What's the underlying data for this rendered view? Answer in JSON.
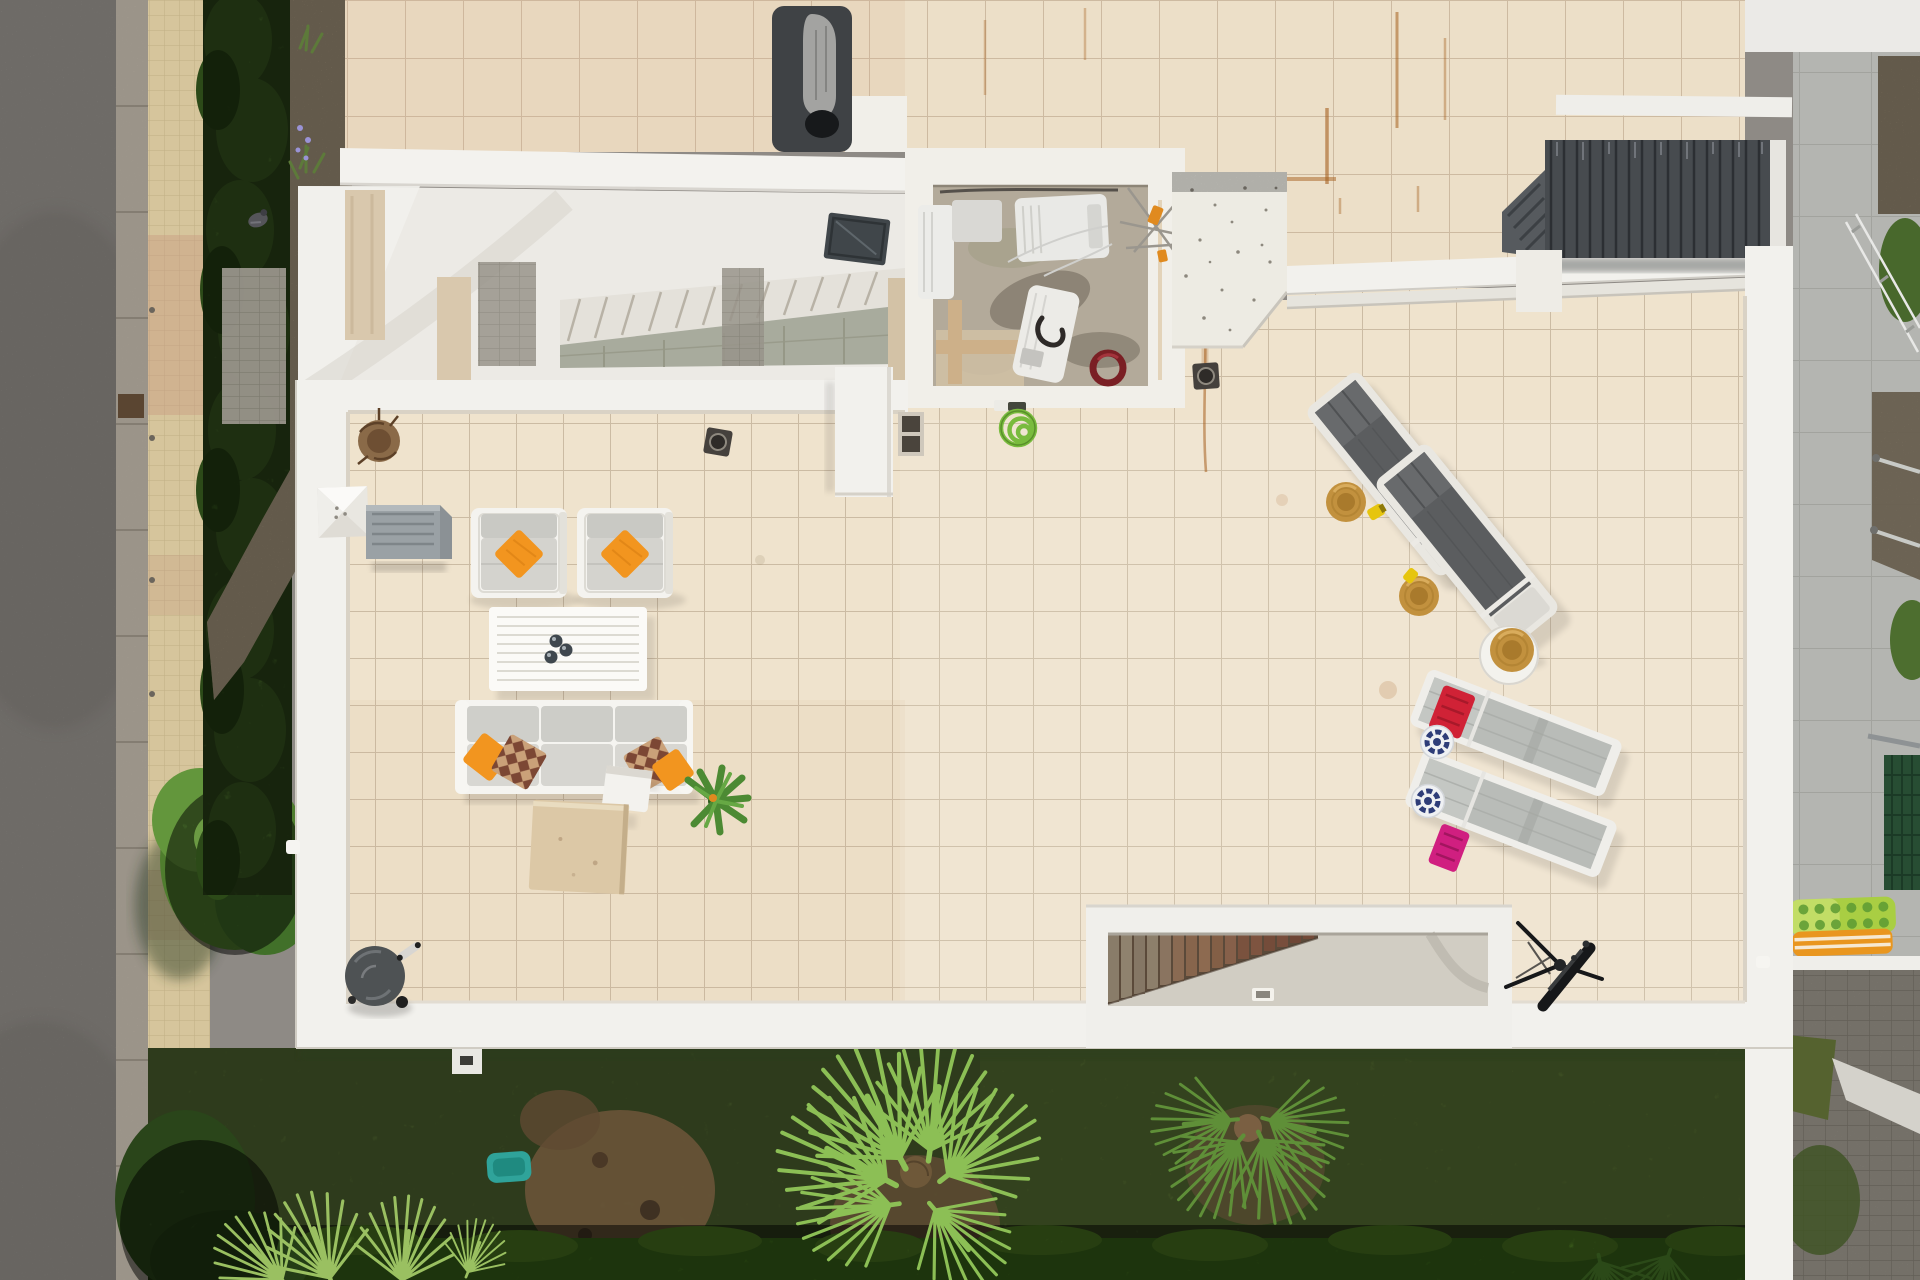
{
  "scene": {
    "description": "Top-down aerial drone photo of a white villa rooftop terrace with outdoor lounge furniture, sun loungers with straw hats, a machine room, a dark pergola, a wooden staircase opening, a telescope, a barbecue, bordered by a road, hedges and a garden with fan palms",
    "view": "top-down aerial"
  },
  "palette": {
    "road": "#8e8a85",
    "curb": "#b2aa9d",
    "sidewalk": "#d6c59c",
    "hedge_dark": "#34511e",
    "gravel": "#9a8c74",
    "wall_white": "#f2f1ed",
    "tile_main": "#efe3cd",
    "tile_upper": "#ecdfc8",
    "grout": "#cbbba3",
    "rust": "#a55f1e",
    "porch_ceiling": "#eceae5",
    "machine_floor": "#b3aa9a",
    "pergola_dark": "#474b4f",
    "lounger_dark_fabric": "#5b5d5f",
    "lounger_light_fabric": "#b9bcb8",
    "cushion_gray": "#d4d3ce",
    "pillow_orange": "#f2951f",
    "hat_straw": "#c2913e",
    "towel_red": "#d02236",
    "towel_pink": "#d01f80",
    "hat_navy": "#2e3d78",
    "stair_wood": "#86654d",
    "landing_concrete": "#d1cdc3",
    "grass": "#4c612e",
    "hedge_bright": "#3c6a1b",
    "palm_green": "#8cbf55",
    "neighbor_tile": "#b4b5b1",
    "cobble": "#8f8a80",
    "float_lime": "#a9ce43",
    "float_orange": "#e9961f",
    "teal_roller": "#2fa39a",
    "bbq_lid": "#4e5254",
    "telescope_black": "#17181a"
  },
  "objects": {
    "road": "asphalt road",
    "sidewalk": "tan tiled sidewalk",
    "hedge_row": "tall hedge row along sidewalk",
    "gravel_bed": "gravel planting bed with small plants",
    "big_tree": "leafy green tree over the sidewalk",
    "upper_roof": "upper tiled roof terrace",
    "sculpture": "gray sculpture on dark mat",
    "porch": "double-height porch void with interior staircase",
    "interior_stairs": "interior staircase seen through void",
    "skylight": "dark roof skylight",
    "machine_room": "open machine room with AC units, cables and antenna",
    "hose_coil_red": "coiled red hose",
    "concrete_block": "white concrete block structure",
    "pergola": "dark slatted pergola",
    "upper_parapet": "white parapet wall between terraces",
    "main_terrace": "large cream tiled rooftop terrace",
    "pyramid_cap": "white pyramid skylight cap",
    "gray_box": "gray metal unit",
    "dried_plant": "dried round plant",
    "armchair_left": "outdoor armchair with orange pillow",
    "armchair_right": "outdoor armchair with orange pillow",
    "coffee_table": "white slatted coffee table with cups",
    "sofa": "three-seat outdoor sofa with orange and patterned pillows",
    "planter_white": "white cube planter",
    "green_plant": "green potted plant",
    "sand_cube": "sand colored concrete cube",
    "hose_spiral": "green spiral hose on tap",
    "drain": "square floor drain",
    "wall_pillar": "white chimney pillar",
    "lounger_dark_1": "sun lounger with dark fabric and straw hat",
    "lounger_dark_2": "sun lounger with dark fabric and straw hat",
    "round_table": "round white table with straw hat",
    "lounger_light_1": "light gray sun lounger with red towel and patterned hat",
    "lounger_light_2": "light gray sun lounger with pink towel and patterned hat",
    "stairwell": "staircase opening with wooden treads and concrete landing",
    "light_fixture": "small light fixture on landing",
    "telescope": "black telescope on tripod",
    "bbq": "round kettle barbecue",
    "lawn": "garden lawn strip",
    "teal_roller": "teal garden object",
    "fan_palm_center": "large fan palm in garden",
    "fan_palm_right": "fan palm near dirt patch",
    "palms_left": "fan palms at garden edge",
    "bright_hedge": "bright trimmed hedge along bottom",
    "neighbor_terrace": "neighbouring gray concrete terrace",
    "glass_railing": "glass railing of neighbour terrace",
    "pool_floats": "lime and orange inflatable floats",
    "mesh_panel": "dark green mesh fence panel",
    "cobble_path": "gray cobble pavers and path"
  }
}
